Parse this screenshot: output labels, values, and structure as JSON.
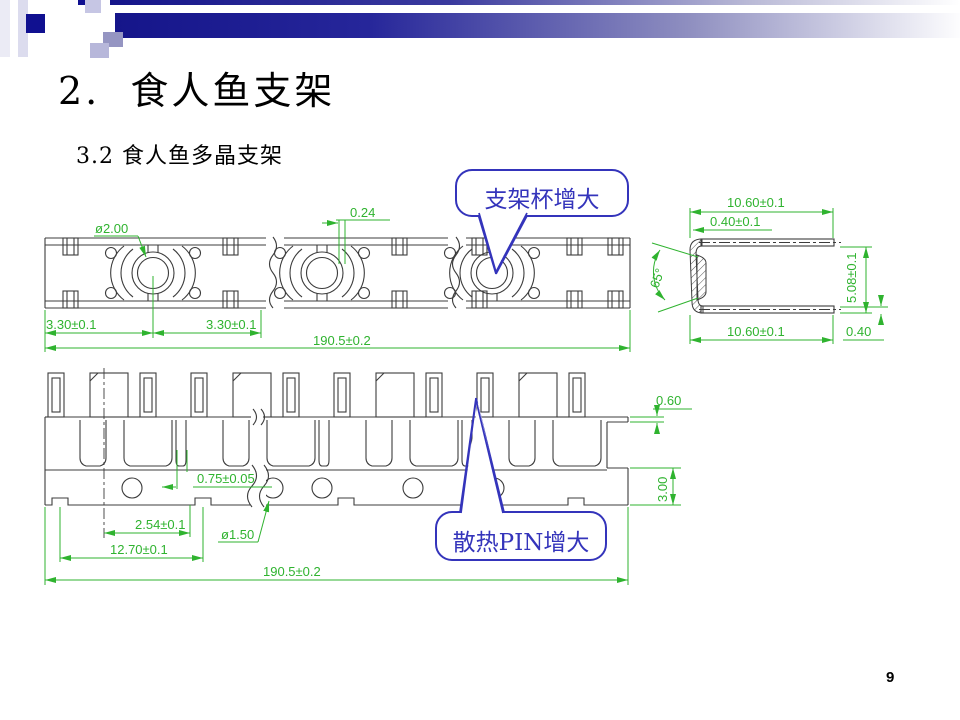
{
  "slide": {
    "title": "2.  食人鱼支架",
    "subtitle": "3.2 食人鱼多晶支架",
    "page_number": "9"
  },
  "callouts": {
    "cup_label": "支架杯增大",
    "pin_label": "散热PIN增大"
  },
  "dims": {
    "top_hole_dia": "ø2.00",
    "top_gap": "0.24",
    "top_pitch_a": "3.30±0.1",
    "top_pitch_b": "3.30±0.1",
    "top_overall": "190.5±0.2",
    "side_width_top": "10.60±0.1",
    "side_thickness_top": "0.40±0.1",
    "side_angle": "65°",
    "side_height": "5.08±0.1",
    "side_width_bottom": "10.60±0.1",
    "side_thickness_bottom": "0.40",
    "front_slot": "0.75±0.05",
    "front_pitch_a": "2.54±0.1",
    "front_pitch_b": "12.70±0.1",
    "front_hole_dia": "ø1.50",
    "front_overall": "190.5±0.2",
    "front_tab": "0.60",
    "front_rail": "3.00"
  },
  "colors": {
    "header_navy": "#101090",
    "dimension_green": "#2fb32f",
    "callout_blue": "#3434bb",
    "drawing_line": "#3c3c3c"
  }
}
